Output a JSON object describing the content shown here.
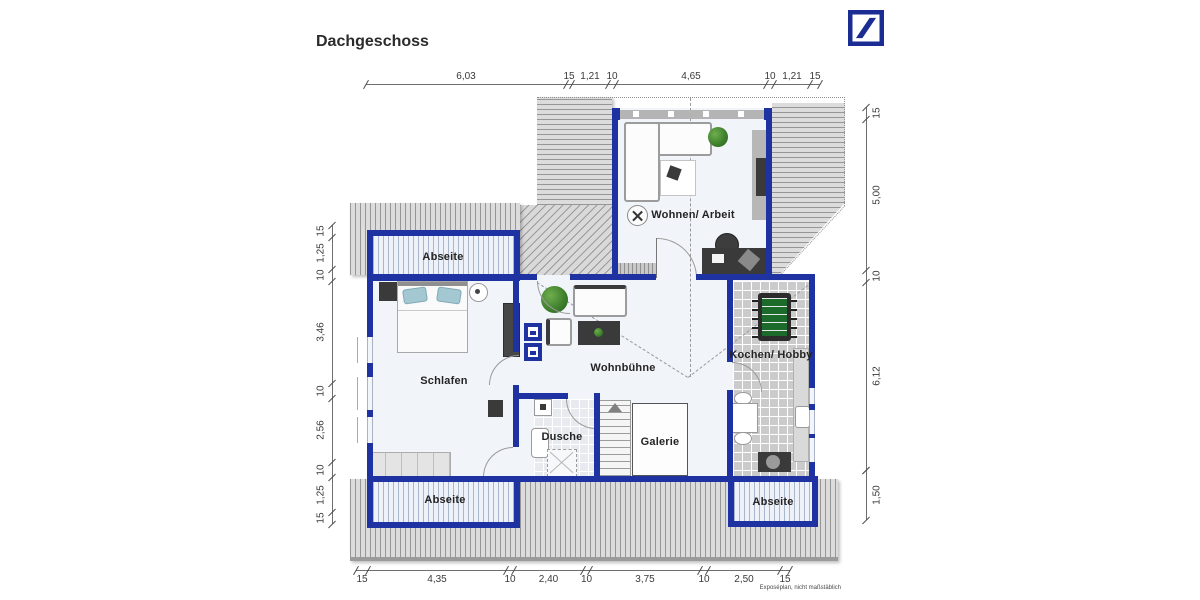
{
  "title": "Dachgeschoss",
  "logo": {
    "name": "Deutsche Bank",
    "color": "#1b2d92"
  },
  "rooms": [
    {
      "id": "abseite-top",
      "label": "Abseite"
    },
    {
      "id": "wohnen-arbeit",
      "label": "Wohnen/ Arbeit"
    },
    {
      "id": "schlafen",
      "label": "Schlafen"
    },
    {
      "id": "wohnbuehne",
      "label": "Wohnbühne"
    },
    {
      "id": "kochen-hobby",
      "label": "Kochen/ Hobby"
    },
    {
      "id": "dusche",
      "label": "Dusche"
    },
    {
      "id": "galerie",
      "label": "Galerie"
    },
    {
      "id": "abseite-bottom-left",
      "label": "Abseite"
    },
    {
      "id": "abseite-bottom-right",
      "label": "Abseite"
    }
  ],
  "dimensions": {
    "top": [
      "6,03",
      "15",
      "1,21",
      "10",
      "4,65",
      "10",
      "1,21",
      "15"
    ],
    "bottom": [
      "15",
      "4,35",
      "10",
      "2,40",
      "10",
      "3,75",
      "10",
      "2,50",
      "15"
    ],
    "left": [
      "15",
      "1,25",
      "10",
      "3,46",
      "10",
      "2,56",
      "10",
      "1,25",
      "15"
    ],
    "right": [
      "15",
      "5,00",
      "10",
      "6,12"
    ],
    "right_lower": [
      "1,50"
    ]
  },
  "footnote": "Exposéplan, nicht maßstäblich",
  "colors": {
    "wall_blue": "#1e32a2",
    "logo_blue": "#1b2d92",
    "roof_gray": "#dcdcdc",
    "abseite_stripe": "#a9b6cc",
    "floor": "#f1f5fa",
    "kicker_green": "#1d6b2a",
    "pillow_teal": "#a3c8d2"
  }
}
